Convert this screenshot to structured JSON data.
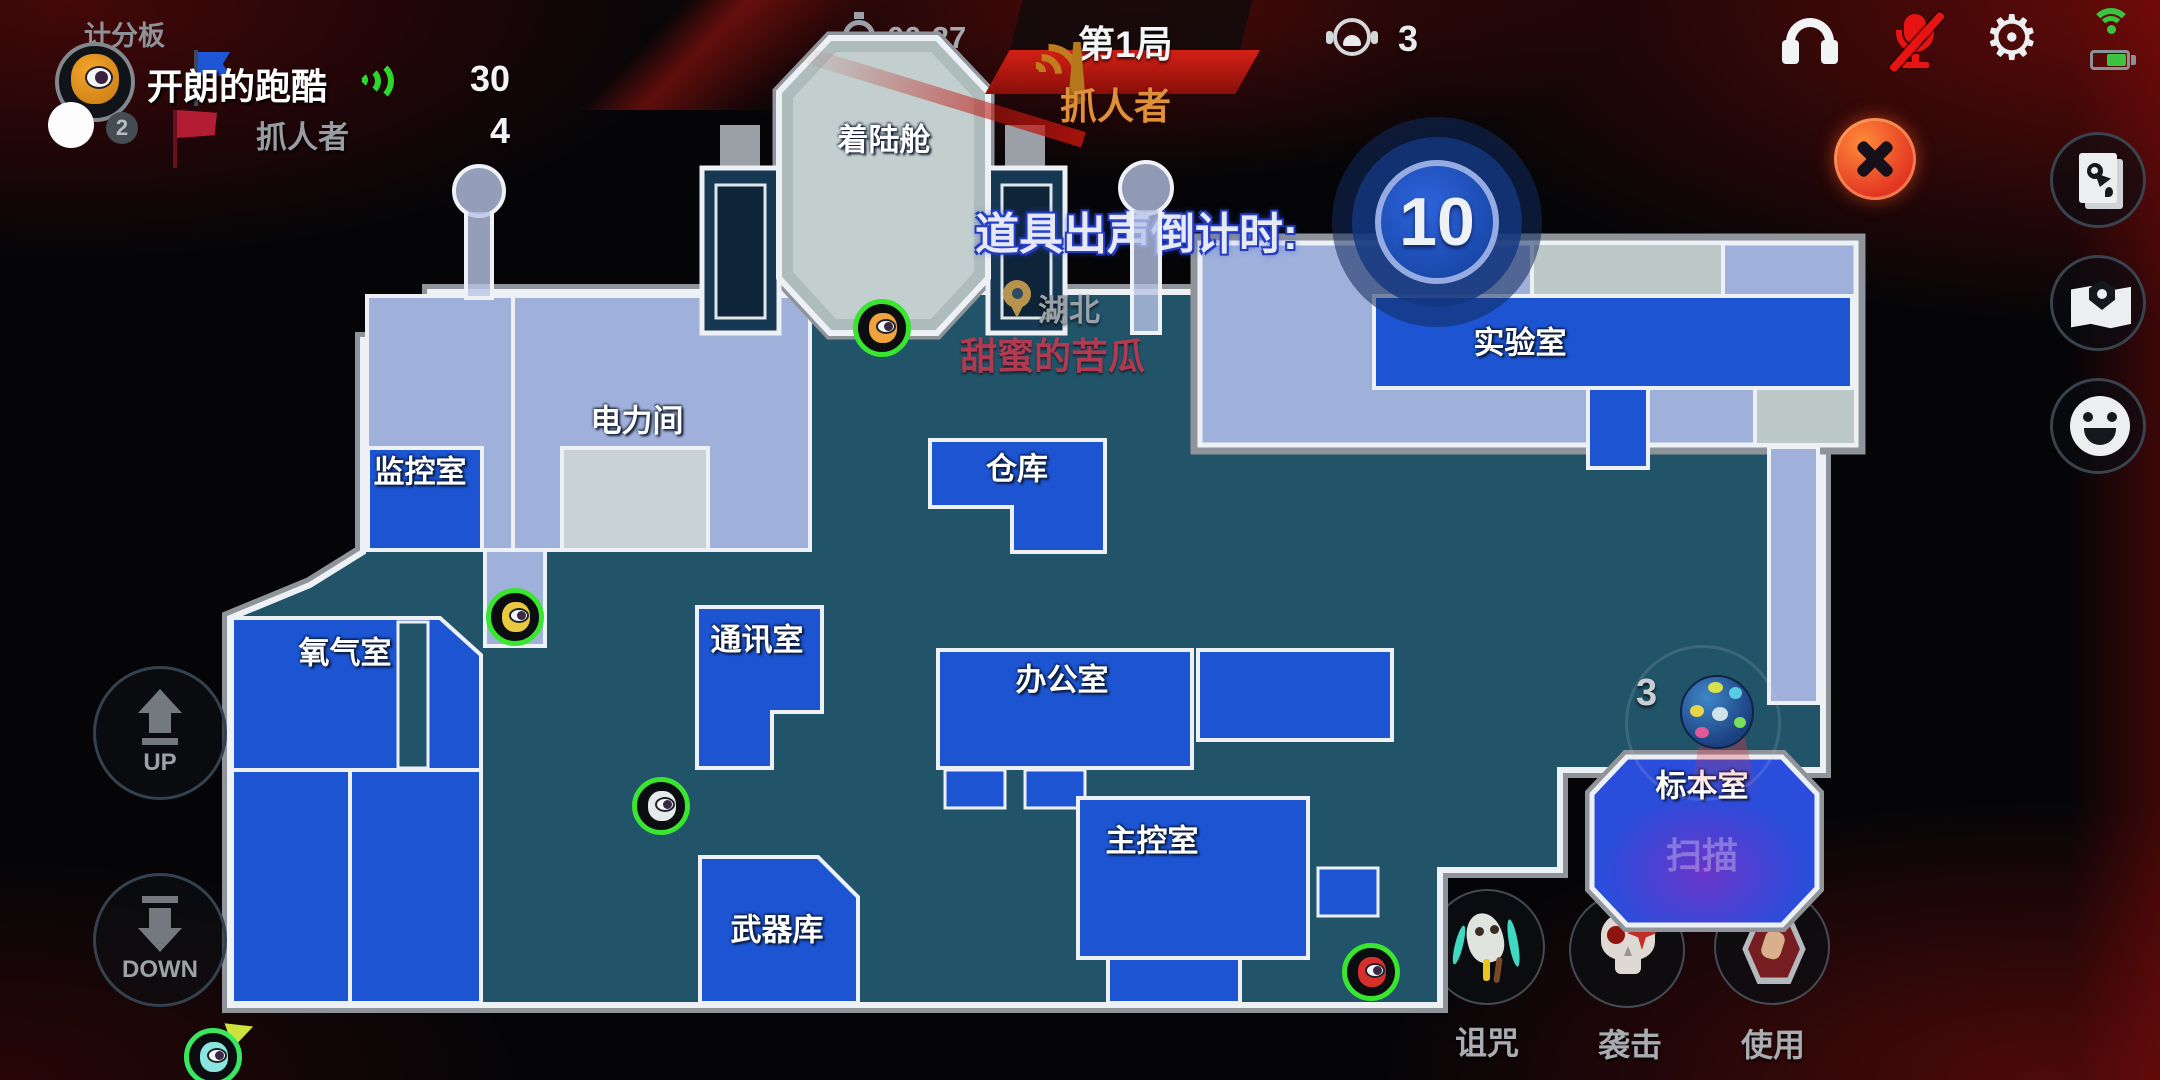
{
  "top_bar": {
    "scoreboard_title": "计分板",
    "timer": "00:27",
    "round": "第1局",
    "role_banner": "抓人者",
    "player_count": "3"
  },
  "scoreboard": {
    "player_name": "开朗的跑酷",
    "player_score": "30",
    "avatar_badge": "2",
    "catcher_label": "抓人者",
    "catcher_score": "4"
  },
  "countdown": {
    "label": "道具出声倒计时:",
    "value": "10"
  },
  "location": {
    "pin_label": "湖北",
    "nearby_player": "甜蜜的苦瓜"
  },
  "map": {
    "rooms": [
      {
        "id": "landing-pod",
        "label": "着陆舱"
      },
      {
        "id": "electrical",
        "label": "电力间"
      },
      {
        "id": "monitoring",
        "label": "监控室"
      },
      {
        "id": "oxygen",
        "label": "氧气室"
      },
      {
        "id": "comms",
        "label": "通讯室"
      },
      {
        "id": "armory",
        "label": "武器库"
      },
      {
        "id": "warehouse",
        "label": "仓库"
      },
      {
        "id": "office",
        "label": "办公室"
      },
      {
        "id": "control",
        "label": "主控室"
      },
      {
        "id": "laboratory",
        "label": "实验室"
      },
      {
        "id": "specimen",
        "label": "标本室"
      }
    ],
    "specimen_scan_label": "扫描",
    "specimen_item_count": "3"
  },
  "movement": {
    "up_label": "UP",
    "down_label": "DOWN"
  },
  "actions": [
    {
      "id": "curse",
      "label": "诅咒"
    },
    {
      "id": "attack",
      "label": "袭击"
    },
    {
      "id": "use",
      "label": "使用"
    }
  ],
  "colors": {
    "room_blue": "#1c54d2",
    "map_teal": "#215369",
    "corridor": "#9fb0da",
    "pod_grey": "#aebcbc",
    "accent_red": "#d32015",
    "role_orange": "#de8f3a",
    "marker_ring_green": "#39e52e",
    "countdown_blue": "#2e63dc",
    "nearby_player_red": "#b23a50"
  }
}
